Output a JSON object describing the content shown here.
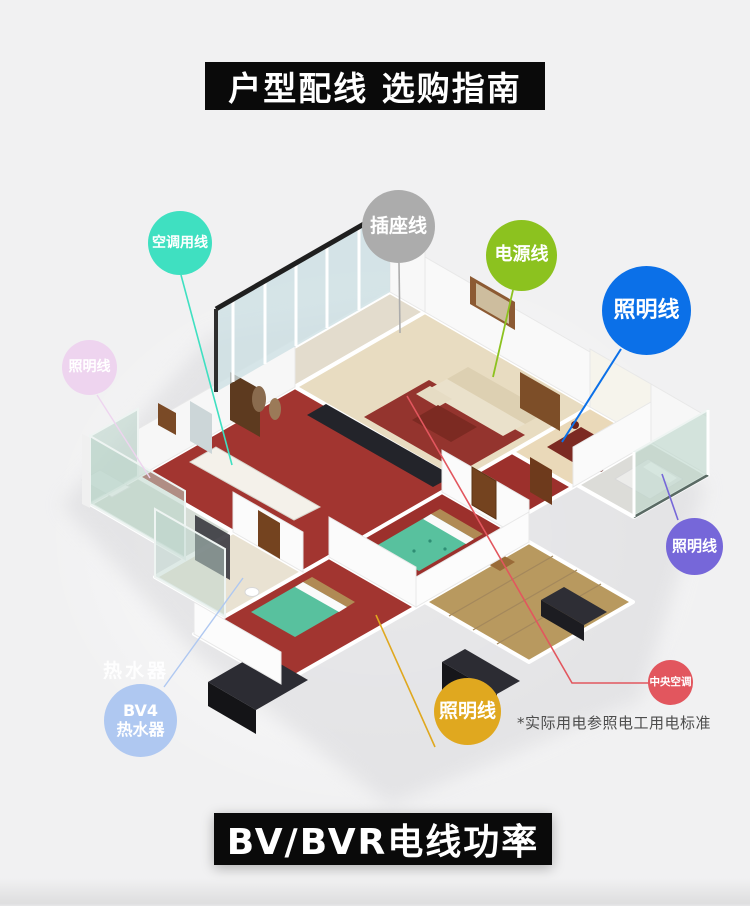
{
  "background": "#f1f1f2",
  "banners": {
    "top": "户型配线 选购指南",
    "bottom": "BV/BVR电线功率",
    "bg": "#0a0a0a",
    "text_color": "#ffffff"
  },
  "note": "*实际用电参照电工用电标准",
  "water_heater_label": "热水器",
  "badge_text_color": "#ffffff",
  "badges": [
    {
      "id": "aircon-wire",
      "text": "空调用线",
      "color": "#3fe0c1"
    },
    {
      "id": "socket-wire",
      "text": "插座线",
      "color": "#acacac"
    },
    {
      "id": "power-wire",
      "text": "电源线",
      "color": "#8cc21f"
    },
    {
      "id": "lighting-wire-blue",
      "text": "照明线",
      "color": "#0b70e8"
    },
    {
      "id": "lighting-wire-pink",
      "text": "照明线",
      "color": "#eed4ef"
    },
    {
      "id": "lighting-wire-purple",
      "text": "照明线",
      "color": "#7667d9"
    },
    {
      "id": "bv4-water-heater",
      "line1": "BV4",
      "line2": "热水器",
      "color": "#afc8f1"
    },
    {
      "id": "lighting-wire-yellow",
      "text": "照明线",
      "color": "#e0a81f"
    },
    {
      "id": "central-ac",
      "text": "中央空调",
      "color": "#e2565e"
    }
  ]
}
